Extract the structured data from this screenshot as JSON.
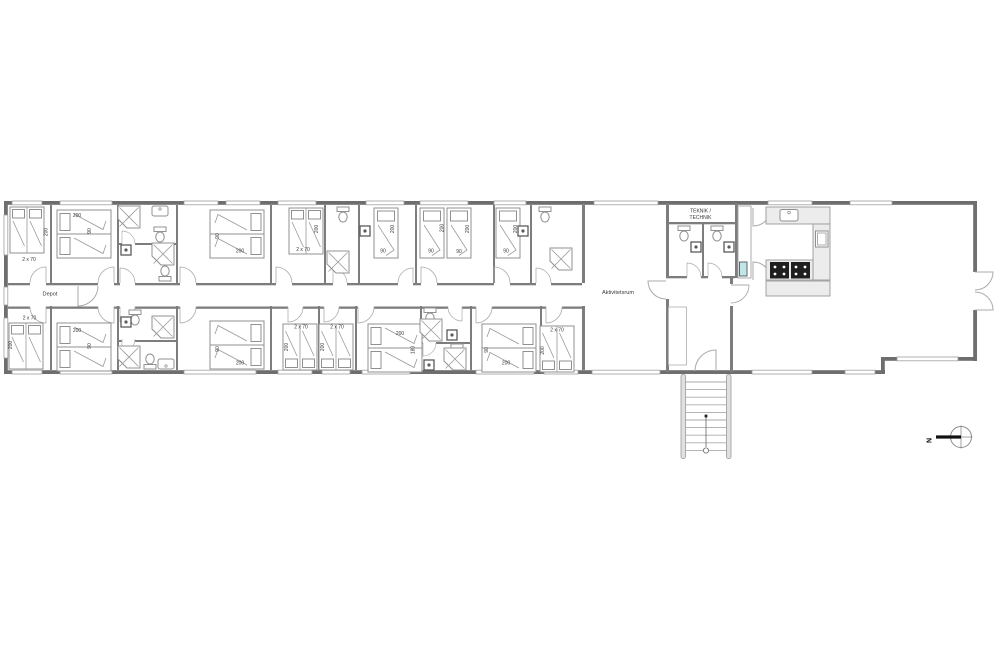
{
  "drawing": {
    "room_labels": {
      "depot": "Depot",
      "aktivitetsrum": "Aktivitetsrum",
      "teknik_line1": "TEKNIK /",
      "teknik_line2": "TECHNIK"
    },
    "bed_dimensions": {
      "length": "200",
      "single_width": "90",
      "double_width": "180",
      "bunk": "2 x 70"
    },
    "compass": {
      "north_label": "N"
    },
    "colors": {
      "background": "#ffffff",
      "wall": "#6e6e6e",
      "interior_wall": "#7d7d7d",
      "furniture_line": "#909090",
      "counter_fill": "#ececec",
      "cooktop": "#1f1f1f",
      "fixture_accent": "#2fa3ad",
      "text": "#3a3a3a"
    }
  }
}
